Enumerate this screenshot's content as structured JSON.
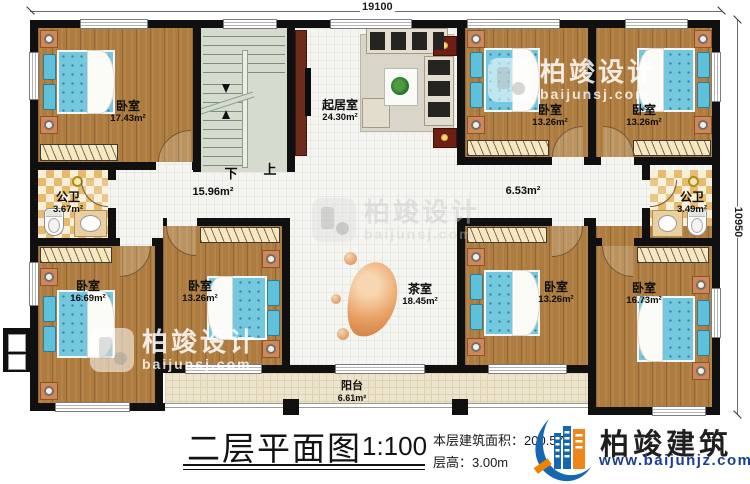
{
  "dimensions": {
    "top": "19100",
    "right": "10950"
  },
  "stairs": {
    "down": "下",
    "up": "上"
  },
  "halls": {
    "left_area": "15.96m²",
    "right_area": "6.53m²"
  },
  "rooms": {
    "bedroom_tl": {
      "name": "卧室",
      "area": "17.43m²"
    },
    "living": {
      "name": "起居室",
      "area": "24.30m²"
    },
    "bedroom_t2": {
      "name": "卧室",
      "area": "13.26m²"
    },
    "bedroom_t3": {
      "name": "卧室",
      "area": "13.26m²"
    },
    "bath_left": {
      "name": "公卫",
      "area": "3.67m²"
    },
    "bath_right": {
      "name": "公卫",
      "area": "3.49m²"
    },
    "bedroom_b1": {
      "name": "卧室",
      "area": "16.69m²"
    },
    "bedroom_b2": {
      "name": "卧室",
      "area": "13.26m²"
    },
    "tea": {
      "name": "茶室",
      "area": "18.45m²"
    },
    "bedroom_b3": {
      "name": "卧室",
      "area": "13.26m²"
    },
    "bedroom_b4": {
      "name": "卧室",
      "area": "16.73m²"
    },
    "balcony": {
      "name": "阳台",
      "area": "6.61m²"
    }
  },
  "watermark": {
    "brand": "柏竣设计",
    "domain": "baijunsj.com"
  },
  "footer": {
    "title": "二层平面图",
    "scale": "1:100",
    "area_line": "本层建筑面积：200.57",
    "height_line": "层高：3.00m",
    "brand": "柏竣建筑",
    "url": "www.baijunjz.com"
  }
}
